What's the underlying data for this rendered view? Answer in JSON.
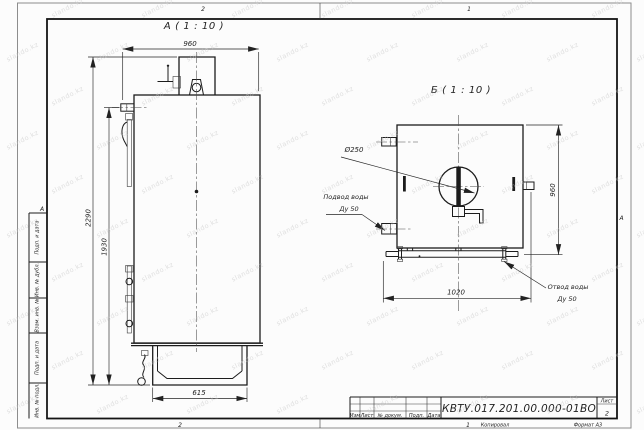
{
  "watermark": {
    "text": "slando.kz"
  },
  "frame": {
    "zone_top_left": "2",
    "zone_top_right": "1",
    "zone_bottom_left": "2",
    "zone_bottom_right": "1",
    "zone_left": "А",
    "zone_right": "А",
    "left_column_cells": [
      "Подп. и дата",
      "Инв. № дубл.",
      "Взам. инв. №",
      "Подп. и дата",
      "Инв. № подл."
    ]
  },
  "title_block": {
    "doc_number": "КВТУ.017.201.00.000-01ВО",
    "col_izm": "Изм",
    "col_list": "Лист",
    "col_docnum": "№ докум.",
    "col_podp": "Подп.",
    "col_data": "Дата",
    "sheet_label": "Лист",
    "sheet_number": "2",
    "copied_label": "Копировал",
    "format_label": "Формат А3"
  },
  "view_a": {
    "label": "А ( 1 : 10 )",
    "dims": {
      "width_top": "960",
      "height_overall": "2290",
      "height_to_stub": "1930",
      "base_width": "615"
    }
  },
  "view_b": {
    "label": "Б ( 1 : 10 )",
    "dims": {
      "height": "960",
      "manifold_length": "1020",
      "chimney_diameter": "Ø250"
    },
    "labels": {
      "inlet_line1": "Подвод воды",
      "inlet_line2": "Ду 50",
      "outlet_line1": "Отвод воды",
      "outlet_line2": "Ду 50"
    }
  }
}
